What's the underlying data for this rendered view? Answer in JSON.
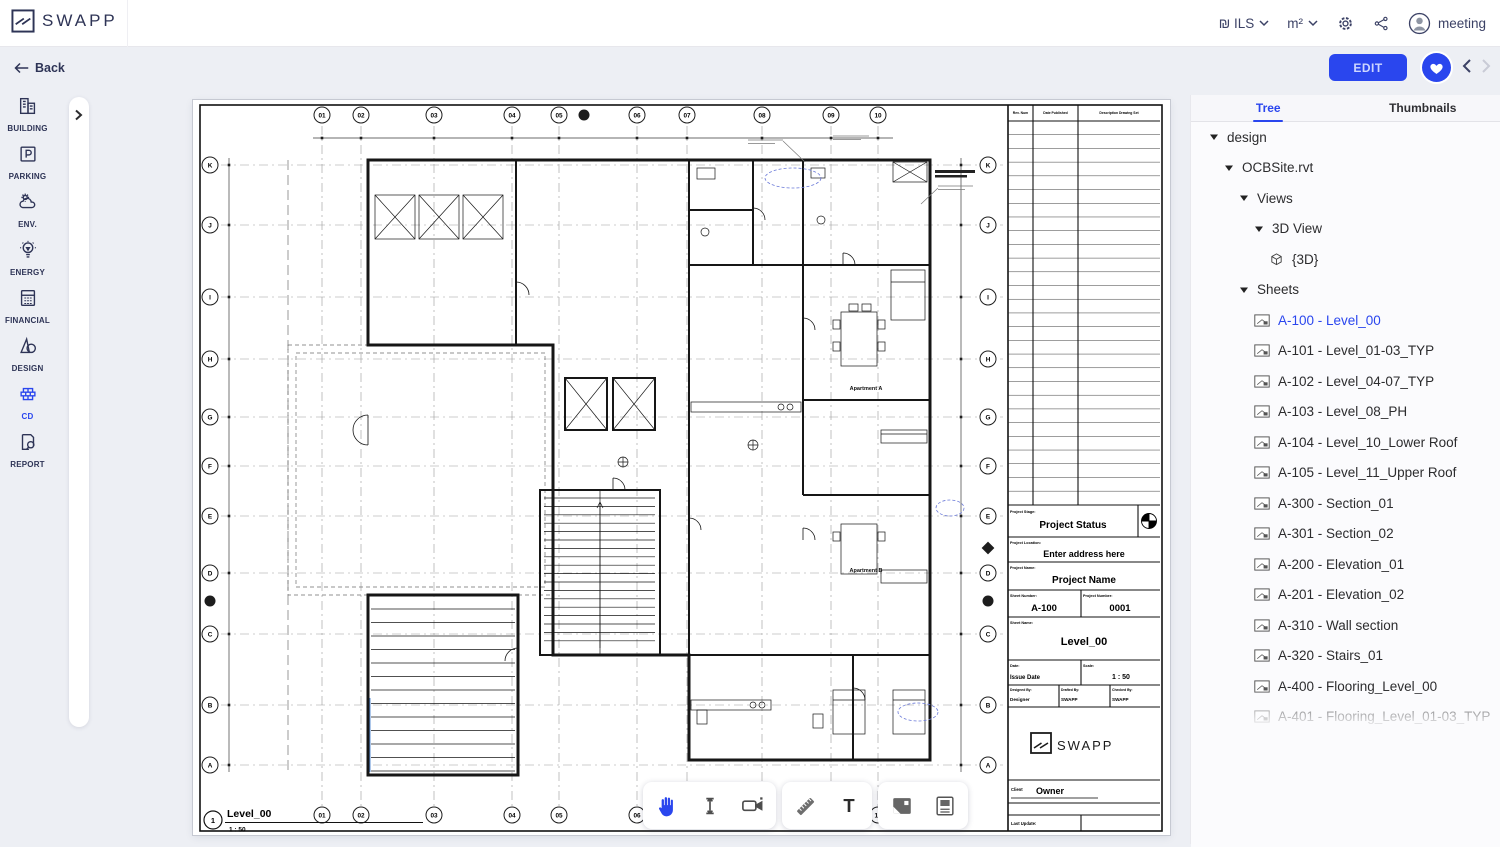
{
  "header": {
    "brand": "SWAPP",
    "currency": "₪ ILS",
    "unit": "m²",
    "user": "meeting"
  },
  "subheader": {
    "back": "Back",
    "edit": "EDIT"
  },
  "sidebar": {
    "items": [
      {
        "id": "building",
        "label": "BUILDING"
      },
      {
        "id": "parking",
        "label": "PARKING"
      },
      {
        "id": "env",
        "label": "ENV."
      },
      {
        "id": "energy",
        "label": "ENERGY"
      },
      {
        "id": "financial",
        "label": "FINANCIAL"
      },
      {
        "id": "design",
        "label": "DESIGN"
      },
      {
        "id": "cd",
        "label": "CD",
        "active": true
      },
      {
        "id": "report",
        "label": "REPORT"
      }
    ]
  },
  "right_panel": {
    "tabs": [
      {
        "id": "tree",
        "label": "Tree",
        "active": true
      },
      {
        "id": "thumbnails",
        "label": "Thumbnails",
        "active": false
      }
    ],
    "tree": [
      {
        "label": "design",
        "depth": 0,
        "icon": "caret"
      },
      {
        "label": "OCBSite.rvt",
        "depth": 1,
        "icon": "caret"
      },
      {
        "label": "Views",
        "depth": 2,
        "icon": "caret"
      },
      {
        "label": "3D View",
        "depth": 3,
        "icon": "caret"
      },
      {
        "label": "{3D}",
        "depth": 4,
        "icon": "cube"
      },
      {
        "label": "Sheets",
        "depth": 2,
        "icon": "caret"
      },
      {
        "label": "A-100 - Level_00",
        "depth": 3,
        "icon": "sheet",
        "selected": true
      },
      {
        "label": "A-101 - Level_01-03_TYP",
        "depth": 3,
        "icon": "sheet"
      },
      {
        "label": "A-102 - Level_04-07_TYP",
        "depth": 3,
        "icon": "sheet"
      },
      {
        "label": "A-103 - Level_08_PH",
        "depth": 3,
        "icon": "sheet"
      },
      {
        "label": "A-104 - Level_10_Lower Roof",
        "depth": 3,
        "icon": "sheet"
      },
      {
        "label": "A-105 - Level_11_Upper Roof",
        "depth": 3,
        "icon": "sheet"
      },
      {
        "label": "A-300 - Section_01",
        "depth": 3,
        "icon": "sheet"
      },
      {
        "label": "A-301 - Section_02",
        "depth": 3,
        "icon": "sheet"
      },
      {
        "label": "A-200 - Elevation_01",
        "depth": 3,
        "icon": "sheet"
      },
      {
        "label": "A-201 - Elevation_02",
        "depth": 3,
        "icon": "sheet"
      },
      {
        "label": "A-310 - Wall section",
        "depth": 3,
        "icon": "sheet"
      },
      {
        "label": "A-320 - Stairs_01",
        "depth": 3,
        "icon": "sheet"
      },
      {
        "label": "A-400 - Flooring_Level_00",
        "depth": 3,
        "icon": "sheet"
      },
      {
        "label": "A-401 - Flooring_Level_01-03_TYP",
        "depth": 3,
        "icon": "sheet"
      },
      {
        "label": "A-402 - Flooring_Level_04-07_TYP",
        "depth": 3,
        "icon": "sheet"
      },
      {
        "label": "A-403 - Flooring_Level_08_PH",
        "depth": 3,
        "icon": "sheet"
      }
    ]
  },
  "toolbar": {
    "groups": [
      {
        "tools": [
          {
            "id": "pan",
            "name": "pan-tool",
            "active": true
          },
          {
            "id": "measurev",
            "name": "vertical-measure-tool"
          },
          {
            "id": "camera",
            "name": "walkthrough-camera-tool"
          }
        ]
      },
      {
        "tools": [
          {
            "id": "ruler",
            "name": "measure-ruler-tool"
          },
          {
            "id": "text",
            "name": "text-tool"
          }
        ]
      },
      {
        "tools": [
          {
            "id": "image",
            "name": "image-tool"
          },
          {
            "id": "template",
            "name": "sheet-template-tool"
          }
        ]
      }
    ]
  },
  "drawing": {
    "grid_columns": [
      "01",
      "02",
      "03",
      "04",
      "05",
      "06",
      "07",
      "08",
      "09",
      "10"
    ],
    "grid_rows": [
      "K",
      "J",
      "I",
      "H",
      "G",
      "F",
      "E",
      "D",
      "C",
      "B",
      "A"
    ],
    "view": {
      "number": "1",
      "name": "Level_00",
      "scale": "1 : 50"
    },
    "plan_labels": {
      "apartment_a": "Apartment A",
      "apartment_b": "Apartment B"
    },
    "titleblock": {
      "rev_headers": [
        "Rev. Num",
        "Date Published",
        "Description Drawing Set"
      ],
      "stage_label": "Project Stage:",
      "stage_value": "Project Status",
      "location_label": "Project Location:",
      "location_value": "Enter address here",
      "name_label": "Project Name:",
      "name_value": "Project Name",
      "sheet_number_label": "Sheet Number:",
      "sheet_number": "A-100",
      "project_number_label": "Project Number:",
      "project_number": "0001",
      "sheet_name_label": "Sheet Name:",
      "sheet_name": "Level_00",
      "date_label": "Date:",
      "date_value": "Issue Date",
      "scale_label": "Scale:",
      "scale_value": "1 : 50",
      "designed_label": "Designed By:",
      "designed_value": "Designer",
      "drafted_label": "Drafted By:",
      "drafted_value": "SWAPP",
      "checked_label": "Checked By:",
      "checked_value": "SWAPP",
      "logo": "SWAPP",
      "client_label": "Client",
      "client_value": "Owner",
      "last_update_label": "Last Update:"
    }
  }
}
